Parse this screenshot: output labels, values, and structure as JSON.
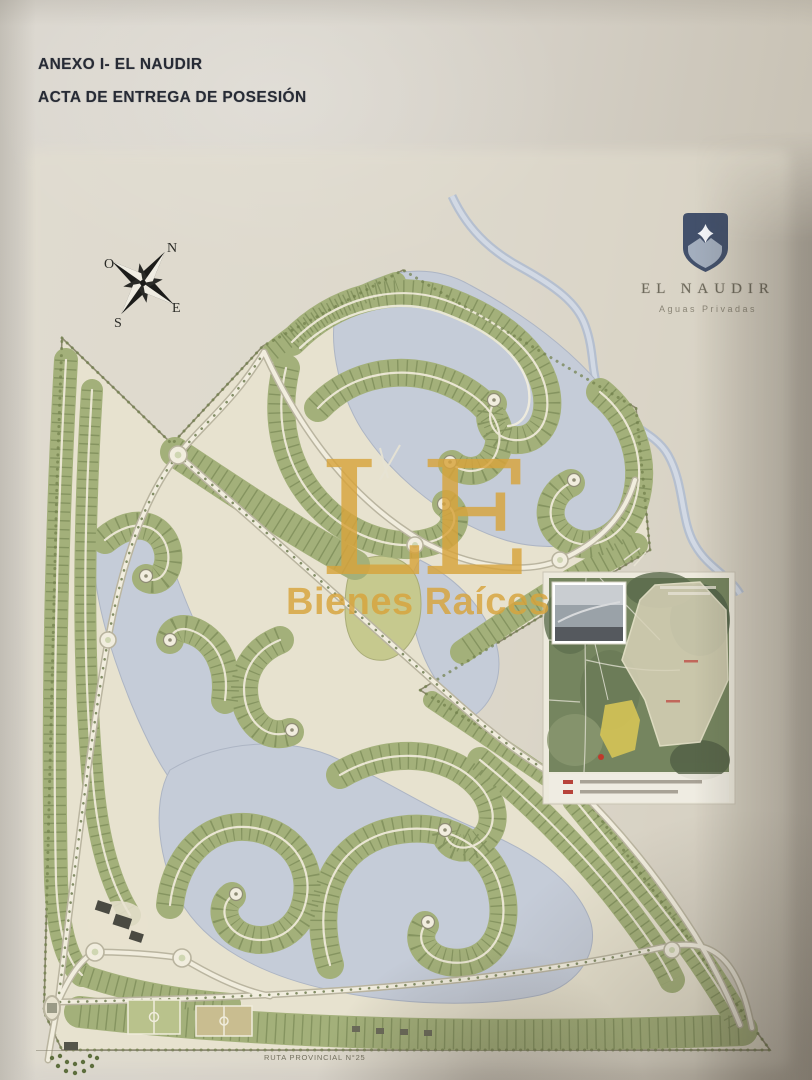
{
  "document": {
    "title_line1": "ANEXO I- EL NAUDIR",
    "title_line2": "ACTA DE ENTREGA DE POSESIÓN"
  },
  "brand": {
    "name": "EL NAUDIR",
    "tagline": "Aguas Privadas"
  },
  "compass": {
    "north": "N",
    "west": "O",
    "east": "E",
    "south": "S"
  },
  "watermark": {
    "initials": "LE",
    "name": "Bienes Raíces",
    "color": "#D8A43C"
  },
  "plan": {
    "route_label": "RUTA PROVINCIAL N°25",
    "colors": {
      "paper": "#D6D2C8",
      "plan_background": "#E7E2CF",
      "lagoon": "#C5CCD8",
      "residential_green": "#A3B07A",
      "tree_green": "#5D6E3D",
      "road": "#F1EDDE",
      "shield_navy": "#42506B",
      "watermark_gold": "#D8A43C"
    }
  },
  "inset_map": {
    "legend_marker_color": "#B7433A",
    "legend_item_count": 2
  }
}
